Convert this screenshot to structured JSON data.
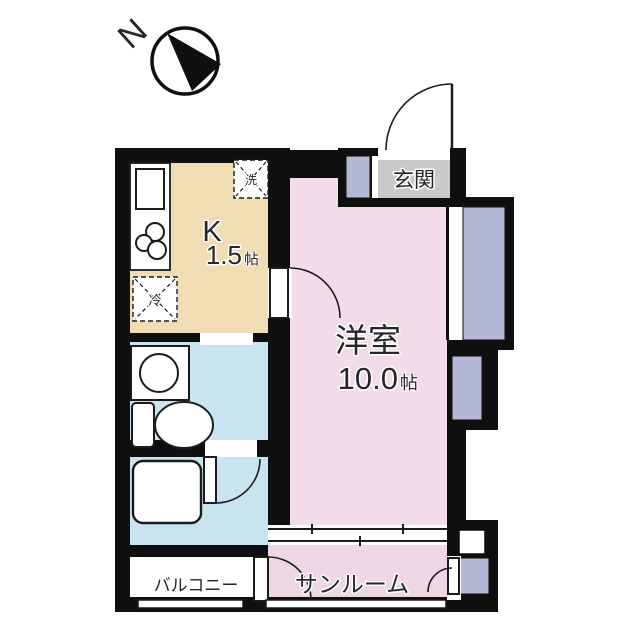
{
  "compass": {
    "north": "N"
  },
  "rooms": {
    "kitchen": {
      "name": "K",
      "size": "1.5",
      "unit": "帖"
    },
    "living": {
      "name": "洋室",
      "size": "10.0",
      "unit": "帖"
    },
    "genkan": {
      "name": "玄関"
    },
    "sunroom": {
      "name": "サンルーム"
    },
    "balcony": {
      "name": "バルコニー"
    }
  },
  "fixtures": {
    "washer": "洗",
    "fridge": "冷"
  },
  "colors": {
    "wall": "#0f0f0f",
    "kitchen": "#f1ddb4",
    "room": "#f2dcea",
    "sunroom": "#eed7e4",
    "wet": "#c8e4ef",
    "closet": "#b4b8d6",
    "genkan": "#c9c9c9",
    "white": "#ffffff"
  }
}
